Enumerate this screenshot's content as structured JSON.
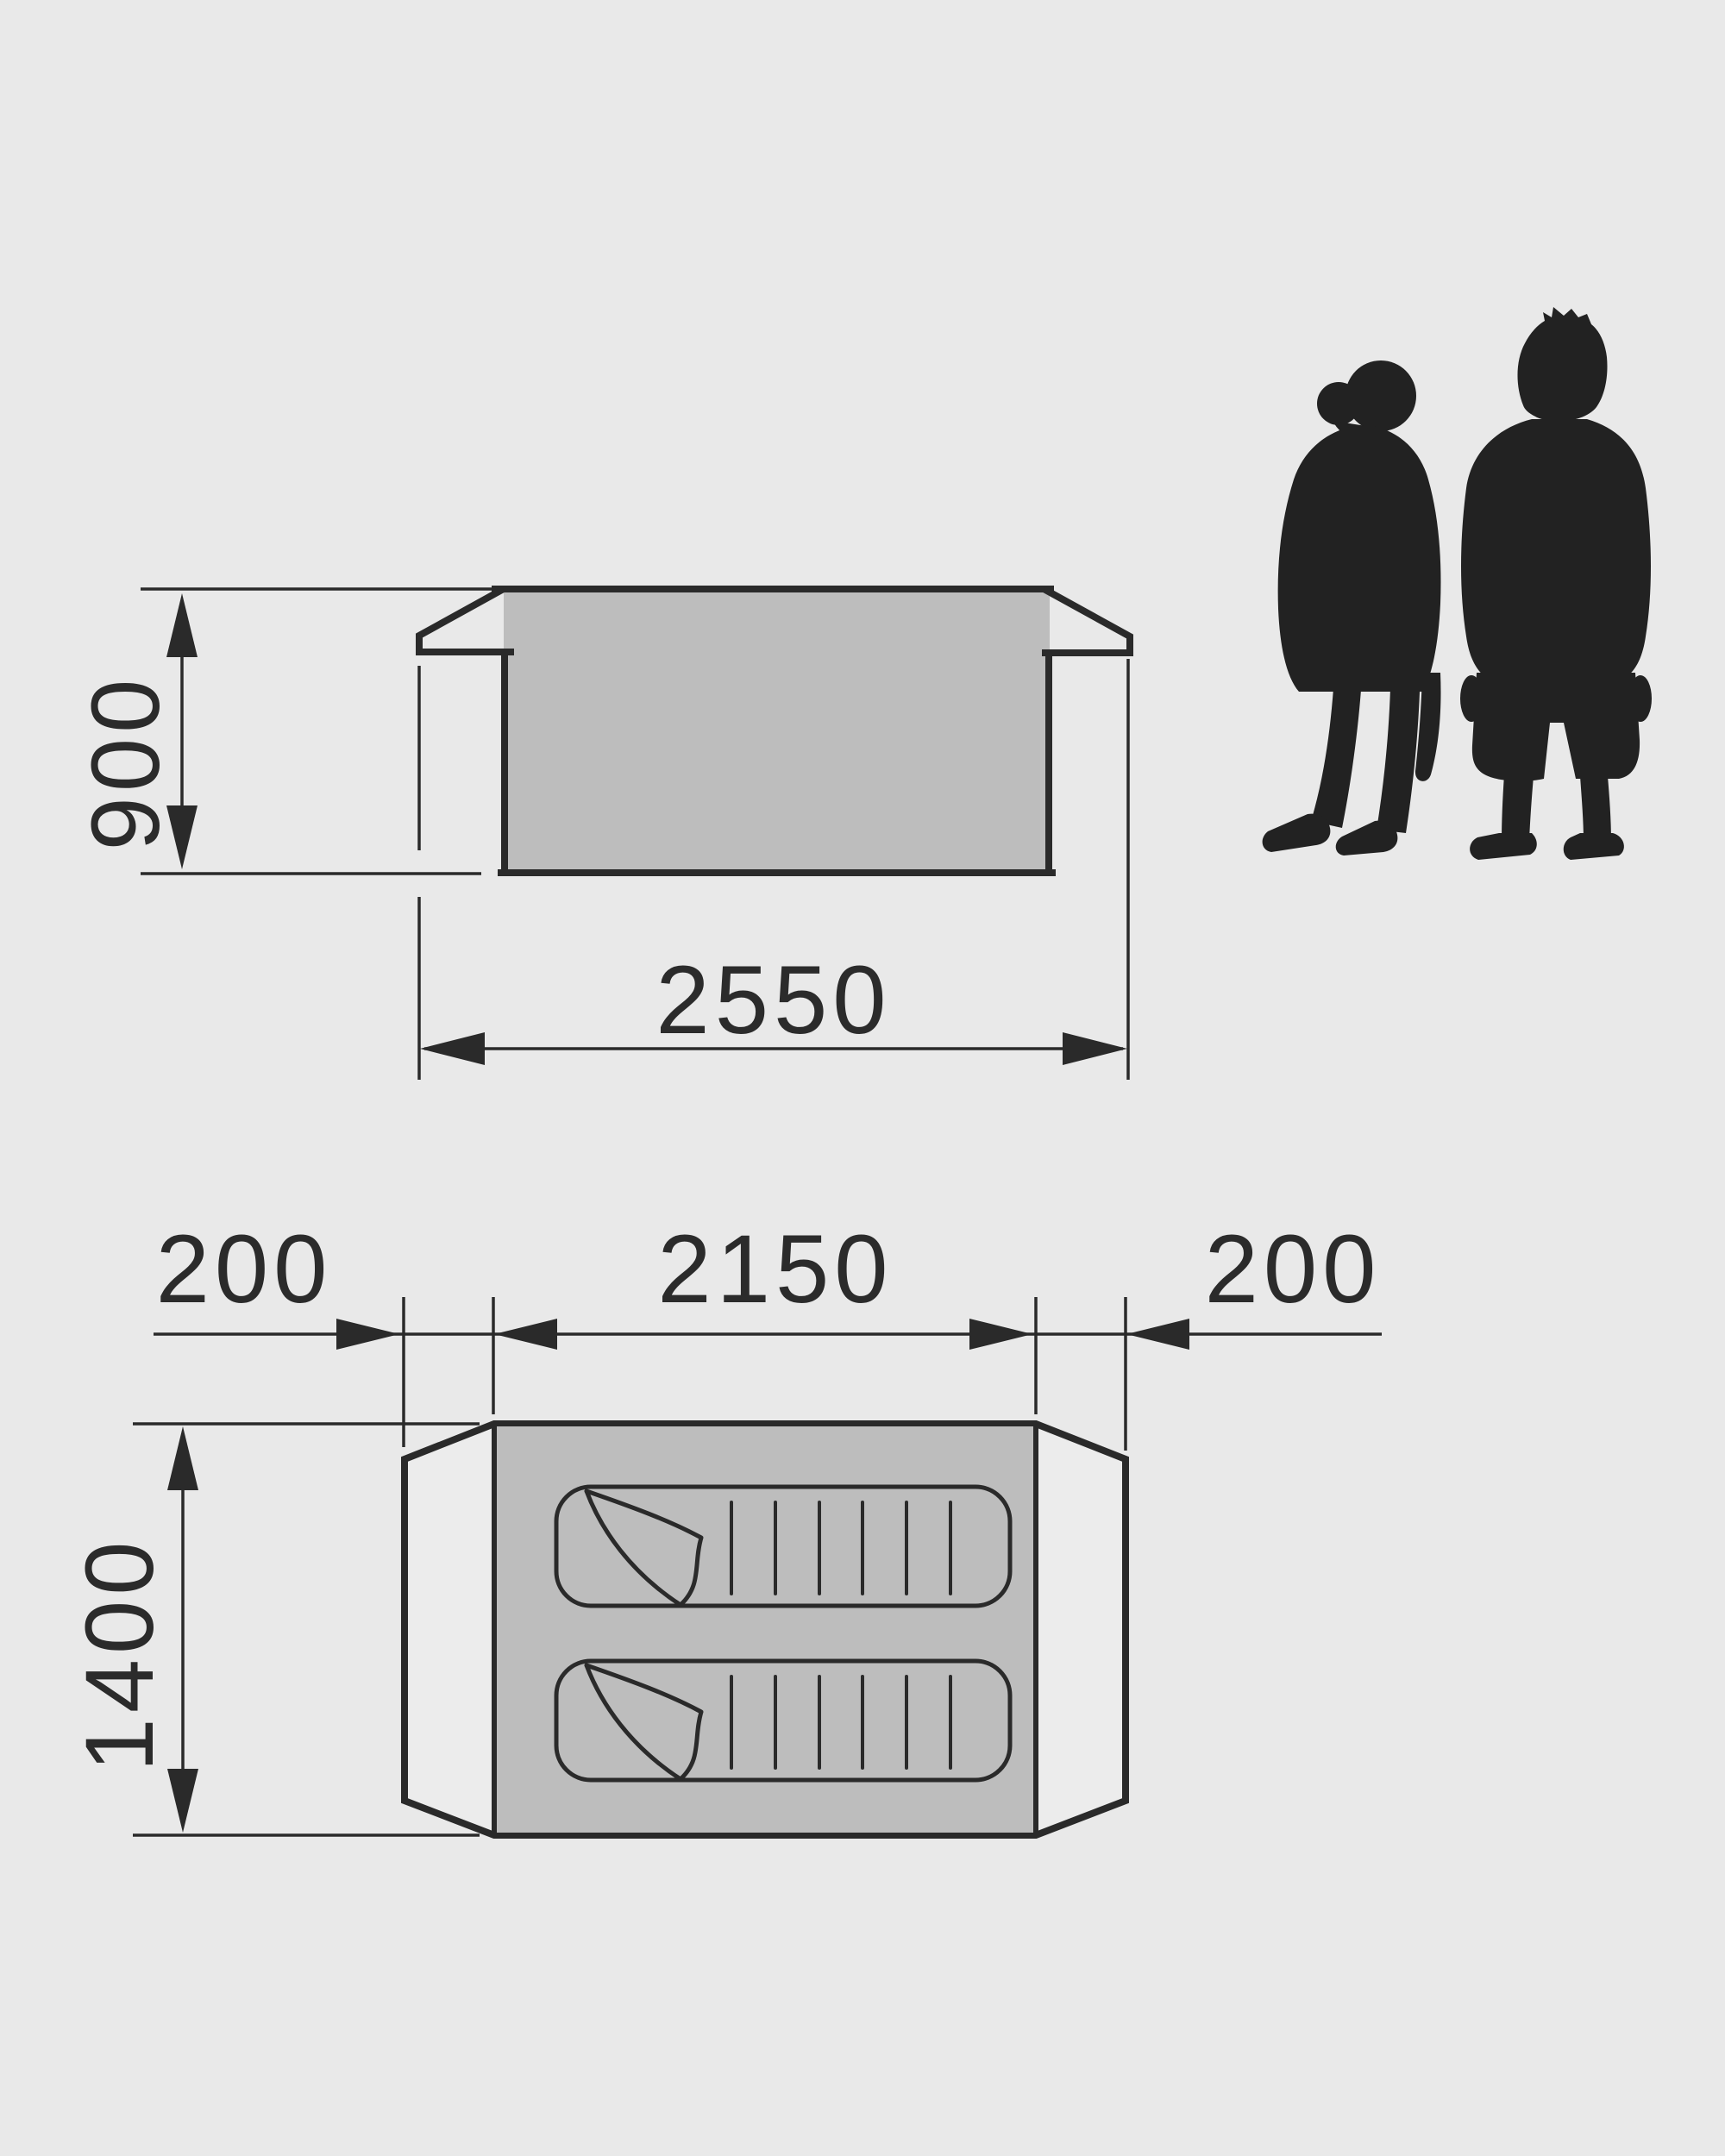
{
  "diagram": {
    "title": "tent dimension drawing",
    "colors": {
      "background": "#e9e9e9",
      "line": "#2a2a2a",
      "tent_fill": "#bdbdbd",
      "ground_panel_fill": "#ececec",
      "silhouette": "#222222",
      "text": "#2b2b2b"
    },
    "icons": {
      "sleeping_bag": "sleeping-bag-icon",
      "people": "person-silhouette"
    },
    "side_view": {
      "height_mm": "900",
      "width_mm": "2550"
    },
    "floor_plan": {
      "left_vestibule_mm": "200",
      "inner_width_mm": "2150",
      "right_vestibule_mm": "200",
      "depth_mm": "1400"
    }
  }
}
